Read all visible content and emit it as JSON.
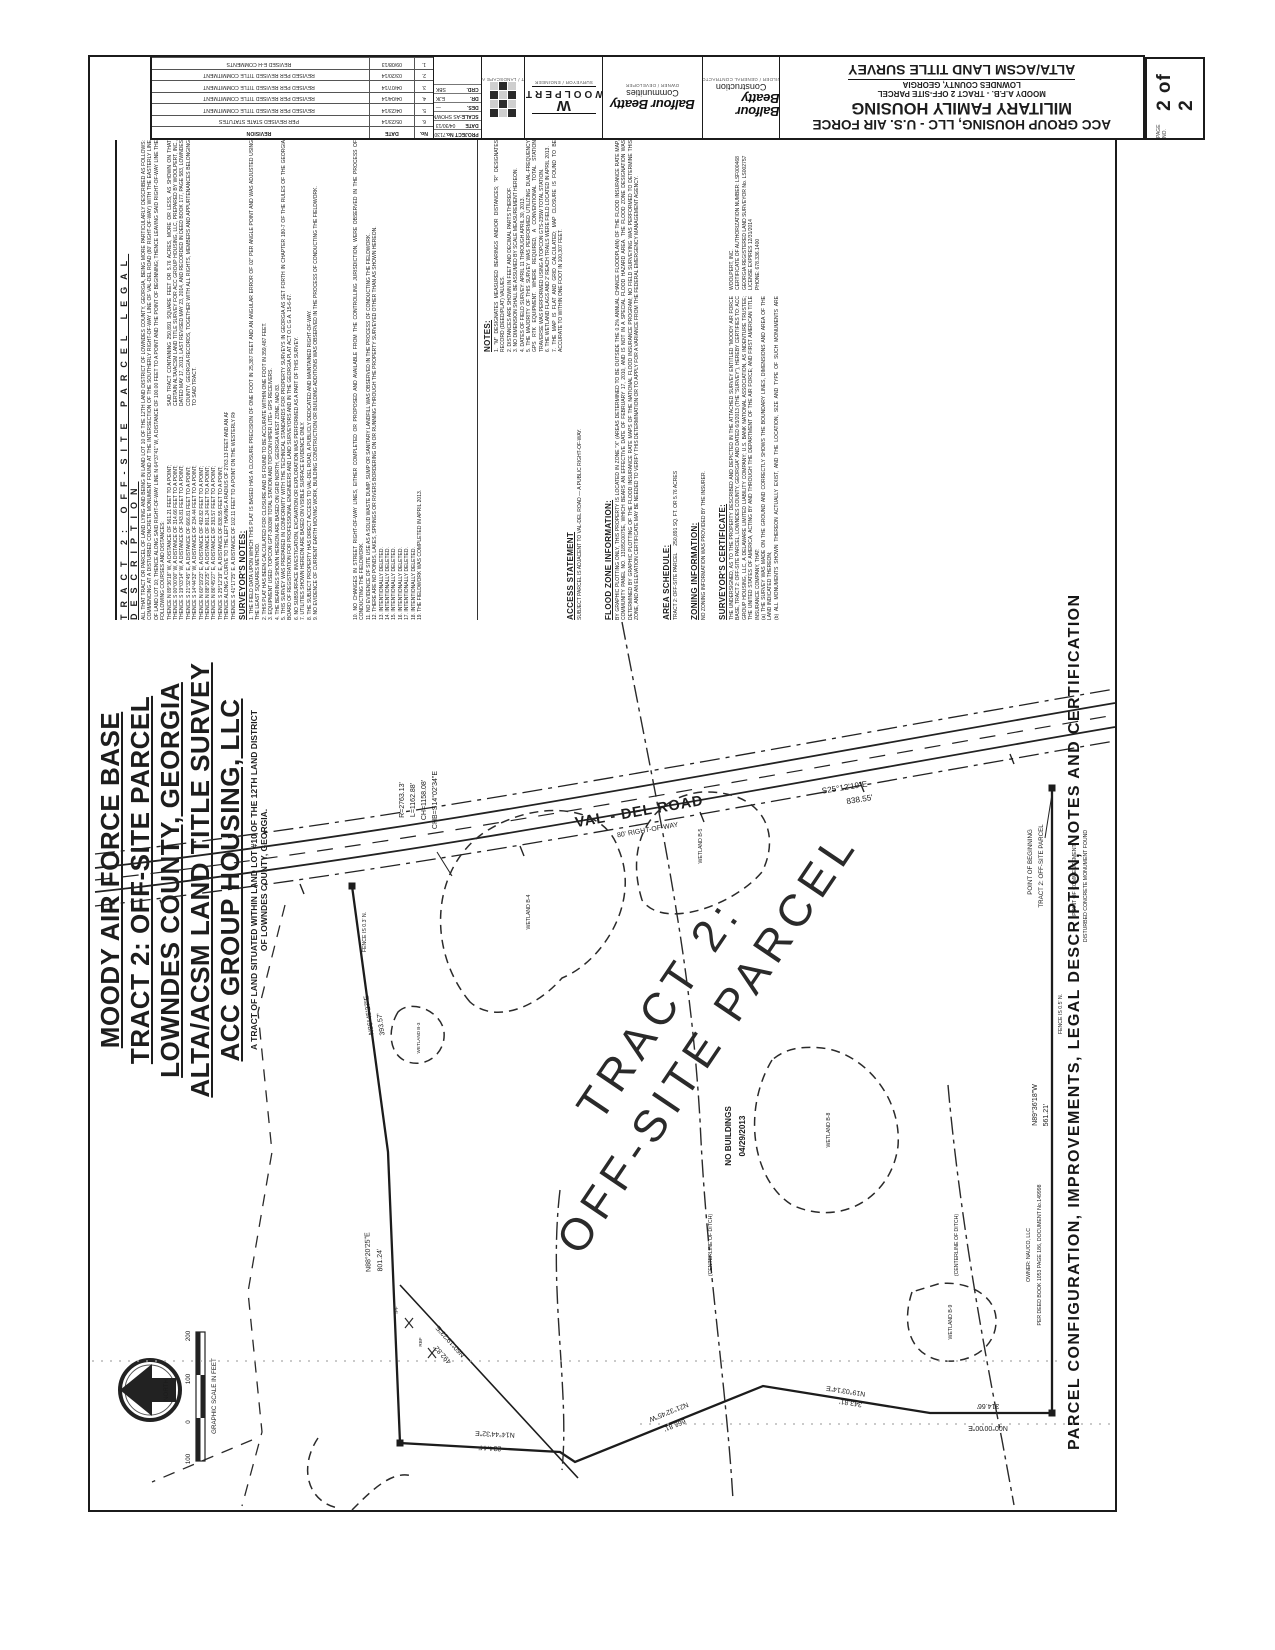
{
  "title_strip": {
    "title_block": {
      "line1": "ACC GROUP HOUSING, LLC - U.S. AIR FORCE",
      "line2": "MILITARY FAMILY HOUSING",
      "line3": "MOODY A.F.B. - TRACT 2 OFF-SITE PARCEL",
      "line4": "LOWNDES COUNTY, GEORGIA",
      "line5": "ALTA/ACSM LAND TITLE SURVEY"
    },
    "page": {
      "label": "PAGE NO.",
      "value": "2 of 2"
    },
    "logos": {
      "construction_caption": "BUILDER / GENERAL CONTRACTOR",
      "construction_name": "Balfour Beatty",
      "construction_sub": "Construction",
      "communities_caption": "OWNER / DEVELOPER",
      "communities_name": "Balfour Beatty",
      "communities_sub": "Communities",
      "woolpert_caption": "SURVEYOR / ENGINEER",
      "woolpert_w": "W",
      "woolpert_name": "WOOLPERT",
      "architect_caption": "ARCHITECT / LANDSCAPE ARCHITECT"
    },
    "project_info": {
      "rows": [
        {
          "label": "PROJECT No.",
          "value": "71307"
        },
        {
          "label": "DATE",
          "value": "04/30/13"
        },
        {
          "label": "SCALE:",
          "value": "AS SHOWN"
        },
        {
          "label": "DES.",
          "value": "—"
        },
        {
          "label": "DR.",
          "value": "EJK"
        },
        {
          "label": "CRD.",
          "value": "SBK"
        }
      ]
    },
    "revision_table": {
      "headers": {
        "no": "No.",
        "date": "DATE",
        "desc": "REVISION"
      },
      "rows": [
        {
          "no": "6.",
          "date": "05/23/14",
          "desc": "PER REVISED STATE STATUTES"
        },
        {
          "no": "5.",
          "date": "04/23/14",
          "desc": "REVISED PER REVISED TITLE COMMITMENT"
        },
        {
          "no": "4.",
          "date": "04/04/14",
          "desc": "REVISED PER REVISED TITLE COMMITMENT"
        },
        {
          "no": "3.",
          "date": "04/07/14",
          "desc": "REVISED PER REVISED TITLE COMMITMENT"
        },
        {
          "no": "2.",
          "date": "03/20/14",
          "desc": "REVISED PER REVISED TITLE COMMITMENT"
        },
        {
          "no": "1.",
          "date": "09/08/13",
          "desc": "REVISED E-H COMMENTS"
        }
      ]
    }
  },
  "main_title": {
    "lines": [
      "MOODY AIR FORCE BASE",
      "TRACT 2: OFF-SITE PARCEL",
      "LOWNDES COUNTY, GEORGIA",
      "ALTA/ACSM LAND TITLE SURVEY",
      "ACC GROUP HOUSING, LLC"
    ],
    "subtitle1": "A TRACT OF LAND SITUATED WITHIN LAND LOT #10 OF THE 12TH LAND DISTRICT",
    "subtitle2": "OF LOWNDES COUNTY, GEORGIA."
  },
  "side_caption": "PARCEL CONFIGURATION, IMPROVEMENTS, LEGAL DESCRIPTION, NOTES AND CERTIFICATION",
  "notes_panel": {
    "legal": {
      "heading": "TRACT 2: OFF-SITE PARCEL LEGAL DESCRIPTION",
      "intro": "ALL THAT TRACT OR PARCEL OF LAND LYING AND BEING IN LAND LOT 10 OF THE 12TH LAND DISTRICT OF LOWNDES COUNTY, GEORGIA, BEING MORE PARTICULARLY DESCRIBED AS FOLLOWS: COMMENCING AT A DISTURBED CONCRETE MONUMENT FOUND AT THE INTERSECTION OF THE SOUTHERLY RIGHT-OF-WAY LINE OF VAL-DEL ROAD (80' RIGHT-OF-WAY) WITH THE EASTERLY LINE OF LAND LOT 10; THENCE ALONG SAID RIGHT-OF-WAY LINE N 64°37'41\" W, A DISTANCE OF 100.00 FEET TO A POINT AND THE POINT OF BEGINNING; THENCE LEAVING SAID RIGHT-OF-WAY LINE THE FOLLOWING COURSES AND DISTANCES:",
      "calls": [
        "THENCE N 89°36'18\" W, A DISTANCE OF 561.21 FEET TO A POINT;",
        "THENCE S 00°00'00\" W, A DISTANCE OF 314.66 FEET TO A POINT;",
        "THENCE S 19°03'14\" W, A DISTANCE OF 343.81 FEET TO A POINT;",
        "THENCE S 21°32'45\" E, A DISTANCE OF 666.81 FEET TO A POINT;",
        "THENCE S 14°44'32\" W, A DISTANCE OF 234.44 FEET TO A POINT;",
        "THENCE N 60°19'23\" E, A DISTANCE OF 492.82 FEET TO A POINT;",
        "THENCE N 88°20'25\" E, A DISTANCE OF 801.24 FEET TO A POINT;",
        "THENCE N 86°45'27\" E, A DISTANCE OF 393.57 FEET TO A POINT;",
        "THENCE S 25°12'19\" E, A DISTANCE OF 838.55 FEET TO A POINT;",
        "THENCE ALONG A CURVE TO THE LEFT HAVING A RADIUS OF 2763.13 FEET AND AN ARC LENGTH OF 1162.88 FEET, BEING SUBTENDED BY A CHORD OF S 14°02'34\" E FOR A DISTANCE OF 1158.08 FEET TO A POINT;",
        "THENCE S 41°17'25\" E, A DISTANCE OF 102.11 FEET TO A POINT ON THE WESTERLY RIGHT-OF-WAY LINE OF VAL-DEL ROAD;"
      ],
      "closing": "SAID TRACT CONTAINING 250,891 SQUARE FEET OR 5.76 ACRES, MORE OR LESS, AS SHOWN ON THAT CERTAIN ALTA/ACSM LAND TITLE SURVEY FOR ACC GROUP HOUSING, LLC, PREPARED BY WOOLPERT, INC., DATED MAY 17, 2013, LAST REVISED MAY 23, 2014, AND RECORDED IN DEED BOOK 177, PAGE 583, LOWNDES COUNTY, GEORGIA RECORDS, TOGETHER WITH ALL RIGHTS, MEMBERS AND APPURTENANCES BELONGING TO SAID TRACT."
    },
    "surveyors_notes": {
      "heading": "SURVEYOR'S NOTES:",
      "items": [
        "1. THE FIELD DATA UPON WHICH THIS PLAT IS BASED HAS A CLOSURE PRECISION OF ONE FOOT IN 25,387 FEET AND AN ANGULAR ERROR OF 02\" PER ANGLE POINT AND WAS ADJUSTED USING THE LEAST SQUARES METHOD.",
        "2. THIS PLAT HAS BEEN CALCULATED FOR CLOSURE AND IS FOUND TO BE ACCURATE WITHIN ONE FOOT IN 359,487 FEET.",
        "3. EQUIPMENT USED: TOPCON GPT-3003W TOTAL STATION AND TOPCON HIPER LITE+ GPS RECEIVERS.",
        "4. THE BEARINGS SHOWN HEREON ARE BASED ON GRID NORTH, GEORGIA WEST ZONE, NAD 83.",
        "5. THIS SURVEY WAS PREPARED IN CONFORMITY WITH THE TECHNICAL STANDARDS FOR PROPERTY SURVEYS IN GEORGIA AS SET FORTH IN CHAPTER 180-7 OF THE RULES OF THE GEORGIA BOARD OF REGISTRATION FOR PROFESSIONAL ENGINEERS AND LAND SURVEYORS AND IN THE GEORGIA PLAT ACT O.C.G.A. 15-6-67.",
        "6. NO SUBSURFACE INVESTIGATION, EXCAVATION OR EXPLORATION WAS PERFORMED AS A PART OF THIS SURVEY.",
        "7. UTILITIES SHOWN HEREON ARE BASED ON VISIBLE SURFACE EVIDENCE ONLY.",
        "8. THE SUBJECT PROPERTY HAS DIRECT ACCESS TO VAL-DEL ROAD, A PUBLICLY DEDICATED AND MAINTAINED RIGHT-OF-WAY.",
        "9. NO EVIDENCE OF CURRENT EARTH MOVING WORK, BUILDING CONSTRUCTION OR BUILDING ADDITIONS WAS OBSERVED IN THE PROCESS OF CONDUCTING THE FIELDWORK."
      ],
      "items2": [
        "10. NO CHANGES IN STREET RIGHT-OF-WAY LINES, EITHER COMPLETED OR PROPOSED AND AVAILABLE FROM THE CONTROLLING JURISDICTION, WERE OBSERVED IN THE PROCESS OF CONDUCTING THE FIELDWORK.",
        "11. NO EVIDENCE OF SITE USE AS A SOLID WASTE DUMP, SUMP OR SANITARY LANDFILL WAS OBSERVED IN THE PROCESS OF CONDUCTING THE FIELDWORK.",
        "12. THERE ARE NO PONDS, LAKES, SPRINGS OR RIVERS BORDERING ON OR RUNNING THROUGH THE PROPERTY SURVEYED OTHER THAN AS SHOWN HEREON.",
        "13. INTENTIONALLY DELETED.",
        "14. INTENTIONALLY DELETED.",
        "15. INTENTIONALLY DELETED.",
        "16. INTENTIONALLY DELETED.",
        "17. INTENTIONALLY DELETED.",
        "18. INTENTIONALLY DELETED.",
        "19. THE FIELDWORK WAS COMPLETED IN APRIL 2013."
      ]
    },
    "notes": {
      "heading": "NOTES:",
      "items": [
        "1. \"M\" DESIGNATES MEASURED BEARINGS AND/OR DISTANCES; \"R\" DESIGNATES RECORD (DEED/PLAT) VALUES.",
        "2. DISTANCES ARE SHOWN IN FEET AND DECIMAL PARTS THEREOF.",
        "3. NO DIMENSION SHALL BE ASSUMED BY SCALE MEASUREMENT HEREON.",
        "4. DATES OF FIELD SURVEY: APRIL 11 THROUGH APRIL 30, 2013.",
        "5. THE MAJORITY OF THIS SURVEY WAS PERFORMED UTILIZING DUAL-FREQUENCY GPS RTK EQUIPMENT. WHERE REQUIRED, A CONVENTIONAL TOTAL STATION TRAVERSE WAS PERFORMED USING A TOPCON GTS-235W TOTAL STATION.",
        "6. THE WETLAND FLAGS AND 2' REACH TRAILS WERE FIELD LOCATED IN APRIL 2013.",
        "7. THE MAP IS FLAT AND GRID CALCULATED; MAP CLOSURE IS FOUND TO BE ACCURATE TO WITHIN ONE FOOT IN 100,307 FEET.",
        "8. THE HORIZONTAL RELATIVE POSITIONAL ACCURACY FOR THIS SURVEY IS CALCULATED TO BE 0.07'.",
        "9. PROPERTY CORNERS FOUND ARE AS NOTED; CORNERS SET ARE 1/2\" REBAR WITH CAP STAMPED \"WOOLPERT\" UNLESS OTHERWISE NOTED."
      ]
    },
    "access": {
      "heading": "ACCESS STATEMENT",
      "text": "SUBJECT PARCEL IS ADJACENT TO VAL-DEL ROAD — A PUBLIC RIGHT-OF-WAY."
    },
    "flood": {
      "heading": "FLOOD ZONE INFORMATION:",
      "text": "BY GRAPHIC PLOTTING ONLY, THIS PROPERTY IS LOCATED IN ZONE \"X\" (AREAS DETERMINED TO BE OUTSIDE THE 0.2% ANNUAL CHANCE FLOODPLAIN) OF THE FLOOD INSURANCE RATE MAP, COMMUNITY PANEL NO. 13185C0075E, WHICH BEARS AN EFFECTIVE DATE OF FEBRUARY 17, 2010, AND IS NOT IN A SPECIAL FLOOD HAZARD AREA. THE FLOOD ZONE DESIGNATION WAS DETERMINED BY GRAPHIC PLOTTING OF THE FLOOD INSURANCE RATE MAPS OF THE NATIONAL FLOOD INSURANCE PROGRAM; NO FIELD SURVEYING WAS PERFORMED TO DETERMINE THIS ZONE, AND AN ELEVATION CERTIFICATE MAY BE NEEDED TO VERIFY THIS DETERMINATION OR TO APPLY FOR A VARIANCE FROM THE FEDERAL EMERGENCY MANAGEMENT AGENCY."
    },
    "area": {
      "heading": "AREA SCHEDULE:",
      "label": "TRACT 2: OFF-SITE PARCEL",
      "value": "250,891 SQ. FT.   OR   5.76 ACRES"
    },
    "zoning": {
      "heading": "ZONING INFORMATION:",
      "text": "NO ZONING INFORMATION WAS PROVIDED BY THE INSURER."
    },
    "certificate": {
      "heading": "SURVEYOR'S CERTIFICATE:",
      "intro": "THE UNDERSIGNED, AS TO THE PROPERTY DESCRIBED AND DEPICTED IN THE ATTACHED SURVEY ENTITLED \"MOODY AIR FORCE BASE, TRACT 2: OFF-SITE PARCEL, LOWNDES COUNTY, GEORGIA\" AND DATED 6/3/2013 (THE \"SURVEY\"), HEREBY CERTIFIES TO: ACC GROUP HOUSING, LLC, A DELAWARE LIMITED LIABILITY COMPANY; U.S. BANK NATIONAL ASSOCIATION, AS INDENTURE TRUSTEE; THE UNITED STATES OF AMERICA, ACTING BY AND THROUGH THE DEPARTMENT OF THE AIR FORCE; AND FIRST AMERICAN TITLE INSURANCE COMPANY, THAT:",
      "items": [
        "(a) THE SURVEY WAS MADE ON THE GROUND AND CORRECTLY SHOWS THE BOUNDARY LINES, DIMENSIONS AND AREA OF THE LAND INDICATED THEREON;",
        "(b) ALL MONUMENTS SHOWN THEREON ACTUALLY EXIST, AND THE LOCATION, SIZE AND TYPE OF SUCH MONUMENTS ARE CORRECTLY SHOWN;",
        "(c) ALL INTERNAL STREETS AND ROADWAYS, IF ANY, ARE SHOWN ON THE SURVEY;",
        "(d) THE SCALE, NORTH DIRECTION AND DISTANCES SHOWN ON THE SURVEY ARE CORRECT;",
        "(e) A VICINITY MAP SHOWING THE SUBJECT PROPERTY IN REFERENCE TO MAJOR STREET INTERSECTIONS IS SHOWN HEREON;",
        "(f) THE SURVEY CORRECTLY SHOWS THE LOCATION OF ALL BUILDINGS, STRUCTURES AND OTHER IMPROVEMENTS SITUATED ON THE SUBJECT PROPERTY (THERE BEING NONE);",
        "(g) EXCEPT AS SHOWN ON THE SURVEY, THERE ARE NO VISIBLE EASEMENTS OR RIGHTS-OF-WAY ACROSS THE SUBJECT PROPERTY."
      ],
      "firm": [
        "WOOLPERT, INC.",
        "CERTIFICATE OF AUTHORIZATION NUMBER: LSF000468",
        "GEORGIA REGISTERED LAND SURVEYOR No. LS002757",
        "LICENSE EXPIRES 12/31/2014",
        "PHONE: 678.336.1400"
      ]
    }
  },
  "map": {
    "road_name": "VAL - DEL ROAD",
    "road_row": "80' RIGHT-OF-WAY",
    "curve": [
      "R=2763.13'",
      "L=1162.88'",
      "CH=1158.08'",
      "CHB=S14°02'34\"E"
    ],
    "bearings": {
      "b1": {
        "b": "N86°45'27\"E",
        "d": "393.57'"
      },
      "b2": {
        "b": "N88°20'25\"E",
        "d": "801.24'"
      },
      "b3": {
        "b": "N14°44'32\"E",
        "d": "234.44'"
      },
      "b4": {
        "b": "N21°32'45\"W",
        "d": "666.81'"
      },
      "b5": {
        "b": "N19°03'14\"E",
        "d": "343.81'"
      },
      "b6": {
        "b": "N00°00'00\"E",
        "d": "314.66'"
      },
      "b7": {
        "b": "N89°36'18\"W",
        "d": "561.21'"
      },
      "b8": {
        "b": "N60°19'23\"E",
        "d": "492.82'"
      },
      "b9": {
        "b": "S25°12'19\"E",
        "d": "838.55'"
      }
    },
    "tract_label1": "TRACT 2:",
    "tract_label2": "OFF-SITE PARCEL",
    "no_buildings1": "NO BUILDINGS",
    "no_buildings2": "04/29/2013",
    "pob1": "POINT OF BEGINNING",
    "pob2": "TRACT 2: OFF-SITE PARCEL",
    "poc1": "POINT OF COMMENCEMENT",
    "poc2": "DISTURBED CONCRETE MONUMENT FOUND",
    "fence1": "FENCE IS 0.3' N.",
    "fence2": "FENCE IS 0.5' N.",
    "owner1": "OWNER: NAUCO, LLC",
    "owner2": "PER DEED BOOK 1053 PAGE 186, DOCUMENT No.149998",
    "centerline": "(CENTERLINE OF DITCH)",
    "wetlands": {
      "w1": "WETLAND B-4",
      "w2": "WETLAND B-5",
      "w3": "WETLAND B-8",
      "w4": "WETLAND B-3",
      "w5": "WETLAND B-9"
    },
    "ipf": "IPF",
    "rbf": "RBF",
    "north_label": "NORTH",
    "scale": {
      "caption": "GRAPHIC SCALE IN FEET",
      "ticks": [
        "200",
        "100",
        "0",
        "100"
      ]
    }
  }
}
